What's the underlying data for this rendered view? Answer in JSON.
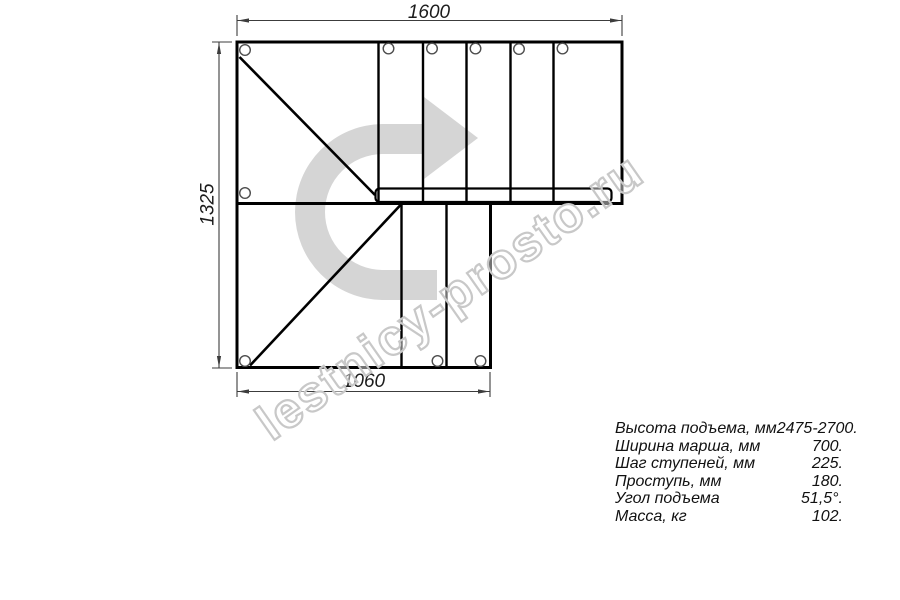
{
  "drawing": {
    "watermark": "lestnicy-prosto.ru",
    "dimensions": {
      "width_top": "1600",
      "height_left": "1325",
      "width_bottom": "1060"
    }
  },
  "specs": {
    "rows": [
      {
        "label": "Высота подъема, мм",
        "value": "2475-2700."
      },
      {
        "label": "Ширина марша, мм",
        "value": "700."
      },
      {
        "label": "Шаг ступеней, мм",
        "value": "225."
      },
      {
        "label": "Проступь, мм",
        "value": "180."
      },
      {
        "label": "Угол подъема",
        "value": "51,5°."
      },
      {
        "label": "Масса, кг",
        "value": "102."
      }
    ]
  },
  "colors": {
    "background": "#ffffff",
    "line": "#000000",
    "dimension": "#3c3c3c",
    "hole_stroke": "#4d4d4d",
    "arrow_fill": "#d5d5d5",
    "watermark_outline": "#c8c8c8"
  }
}
